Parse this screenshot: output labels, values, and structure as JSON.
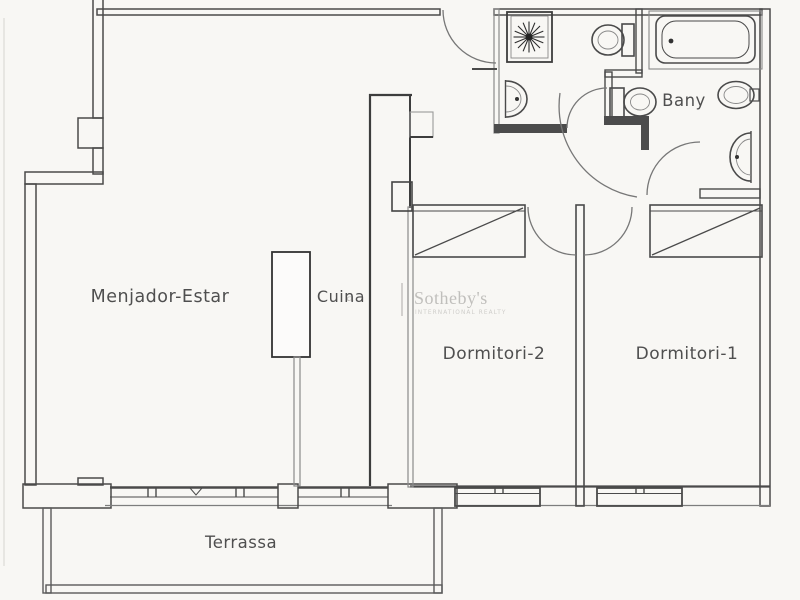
{
  "floor_plan": {
    "title": "Apartment floor plan",
    "rooms": {
      "living": "Menjador-Estar",
      "kitchen": "Cuina",
      "bedroom2": "Dormitori-2",
      "bedroom1": "Dormitori-1",
      "bathroom": "Bany",
      "terrace": "Terrassa"
    },
    "watermark": {
      "prefix": "a",
      "divider": "|",
      "brand": "Sotheby's",
      "tagline": "INTERNATIONAL REALTY"
    },
    "fixtures": [
      "shower-tray",
      "washbasin",
      "toilet",
      "bathtub",
      "toilet",
      "washbasin",
      "washbasin",
      "wardrobe-bedroom2",
      "wardrobe-bedroom1",
      "kitchen-counter"
    ],
    "colors": {
      "background": "#f8f7f4",
      "wall_dark": "#4a4a4a",
      "wall_fill": "#4c4c4c",
      "wall_light": "#8a8a8a",
      "label_text": "#4f4f4f",
      "watermark_text": "#c0bfbc"
    }
  }
}
